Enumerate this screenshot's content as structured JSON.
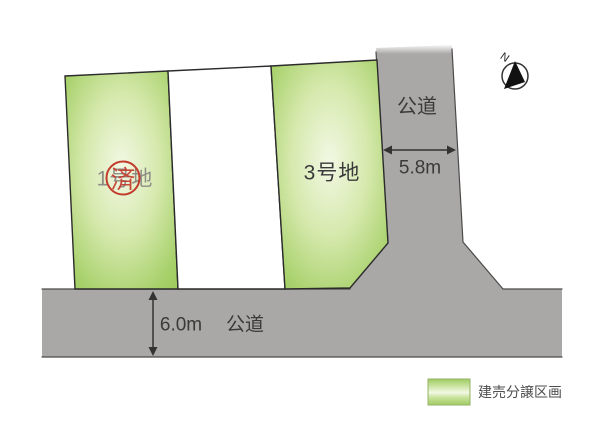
{
  "figure": {
    "compass": {
      "label": "N"
    },
    "lots": {
      "lot1": {
        "label": "1号地",
        "stamp": "済"
      },
      "lot3": {
        "label": "3号地"
      }
    },
    "roads": {
      "vertical": {
        "label": "公道",
        "width_label": "5.8m"
      },
      "horizontal": {
        "label": "公道",
        "width_label": "6.0m"
      }
    },
    "legend": {
      "label": "建売分譲区画"
    },
    "colors": {
      "parcel_green": "#a2ce63",
      "parcel_highlight": "#f2f8e4",
      "road_gray": "#aaa8a7",
      "stamp_red": "#c23b2d",
      "lot1_text_gray": "#8d8d86",
      "ink": "#3a3a3a"
    }
  }
}
